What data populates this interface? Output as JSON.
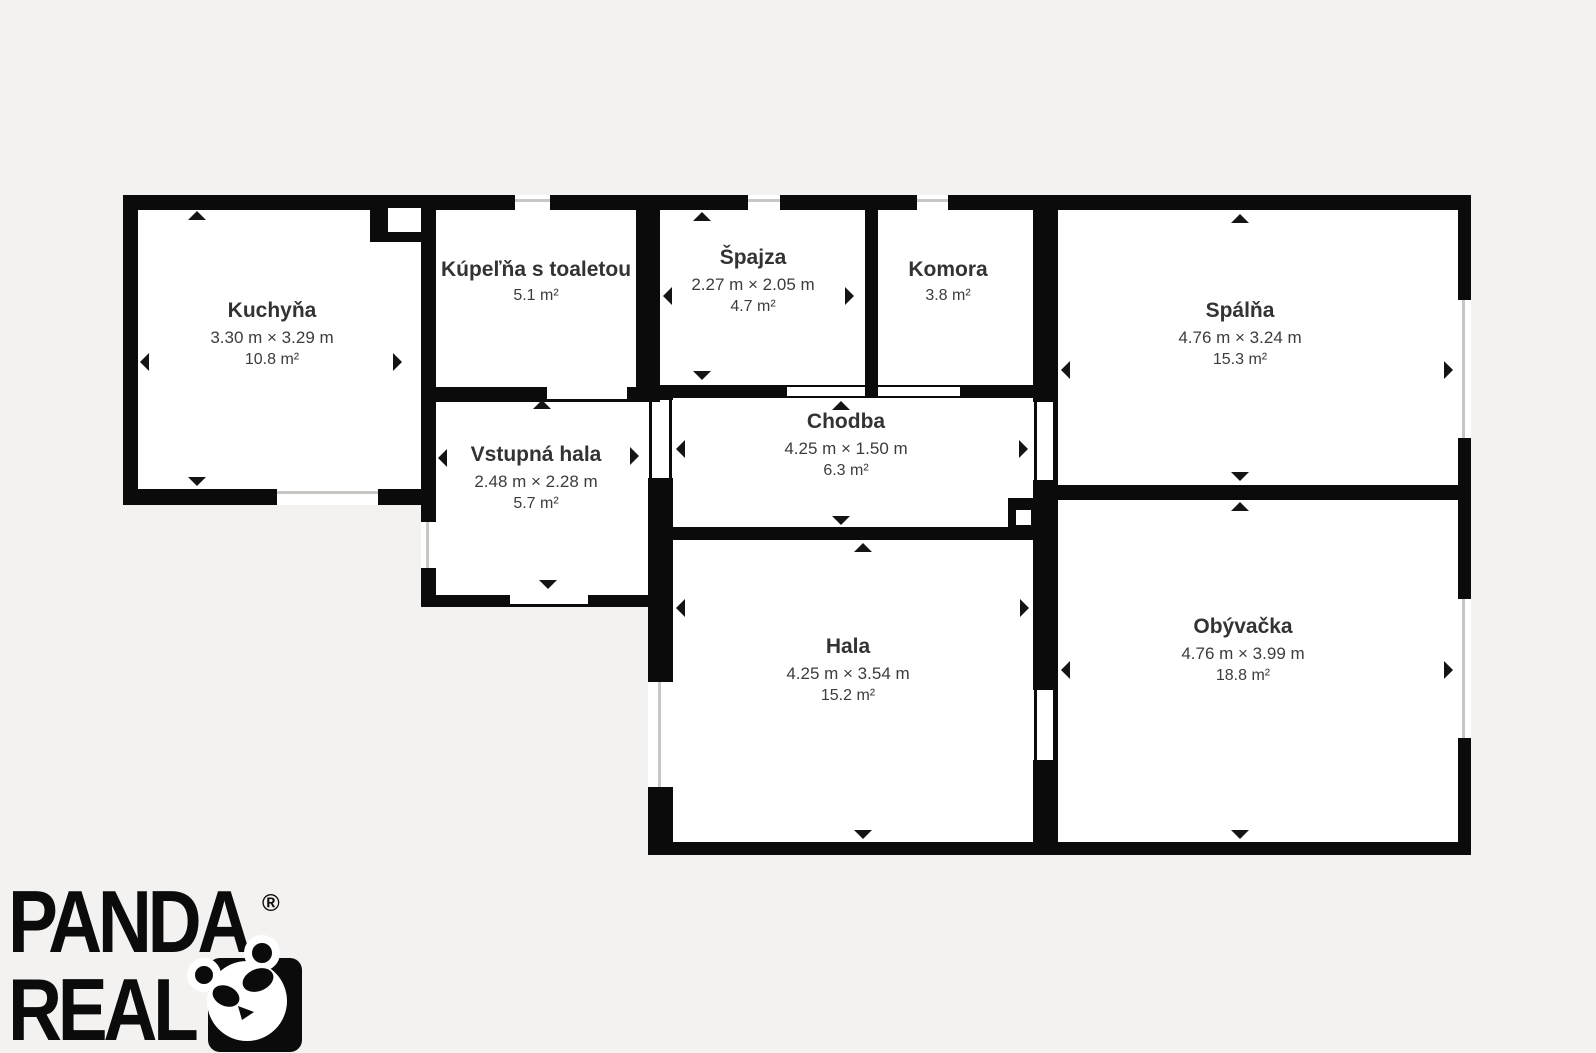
{
  "colors": {
    "background": "#f4f2f0",
    "wall": "#0b0b0b",
    "room_fill": "#ffffff",
    "text": "#3c3c3c",
    "window_line": "#c9c7c3"
  },
  "brand": {
    "name_line1": "PANDA",
    "name_line2": "REAL",
    "registered_mark": "®",
    "panda_icon": "panda-head"
  },
  "rooms": [
    {
      "id": "kuchyna",
      "name": "Kuchyňa",
      "dimensions": "3.30 m × 3.29 m",
      "area": "10.8 m²"
    },
    {
      "id": "kupelna",
      "name": "Kúpeľňa s toaletou",
      "dimensions": "",
      "area": "5.1 m²"
    },
    {
      "id": "spajza",
      "name": "Špajza",
      "dimensions": "2.27 m × 2.05 m",
      "area": "4.7 m²"
    },
    {
      "id": "komora",
      "name": "Komora",
      "dimensions": "",
      "area": "3.8 m²"
    },
    {
      "id": "spalna",
      "name": "Spálňa",
      "dimensions": "4.76 m × 3.24 m",
      "area": "15.3 m²"
    },
    {
      "id": "vstupna-hala",
      "name": "Vstupná hala",
      "dimensions": "2.48 m × 2.28 m",
      "area": "5.7 m²"
    },
    {
      "id": "chodba",
      "name": "Chodba",
      "dimensions": "4.25 m × 1.50 m",
      "area": "6.3 m²"
    },
    {
      "id": "hala",
      "name": "Hala",
      "dimensions": "4.25 m × 3.54 m",
      "area": "15.2 m²"
    },
    {
      "id": "obyvacka",
      "name": "Obývačka",
      "dimensions": "4.76 m × 3.99 m",
      "area": "18.8 m²"
    }
  ]
}
